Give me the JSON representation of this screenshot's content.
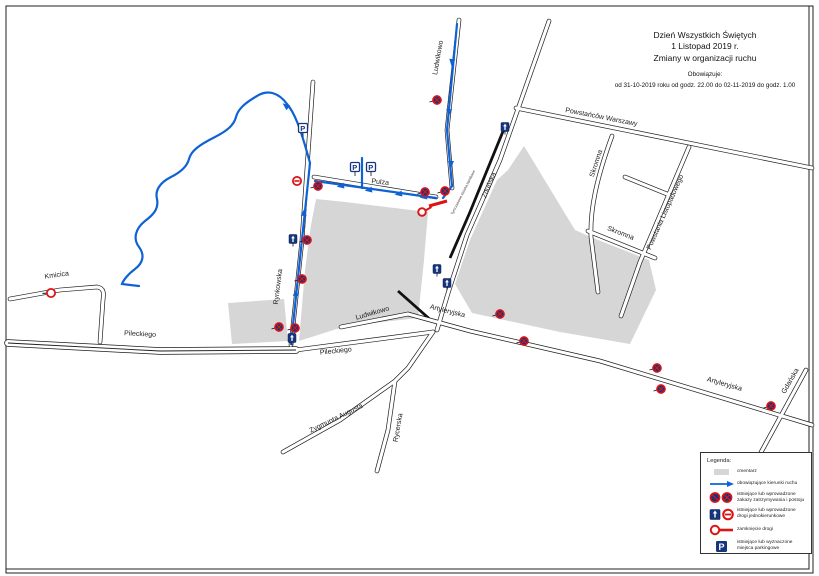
{
  "title_block": {
    "line1": "Dzień Wszystkich Świętych",
    "line2": "1 Listopad 2019 r.",
    "line3": "Zmiany w organizacji ruchu",
    "validity_label": "Obowiązuje:",
    "validity_text": "od 31-10-2019 roku od godz. 22.00 do 02-11-2019 do godz. 1.00"
  },
  "legend": {
    "title": "Legenda:",
    "items": [
      {
        "icon": "cemetery-swatch",
        "label": "cmentarz"
      },
      {
        "icon": "direction-arrow",
        "label": "obowiązujące kierunki ruchu"
      },
      {
        "icon": "no-stopping-signs",
        "label": "istniejące lub wprowadzone zakazy zatrzymywania i postoju"
      },
      {
        "icon": "one-way-signs",
        "label": "istniejące lub wprowadzone drogi jednokierunkowe"
      },
      {
        "icon": "road-closure",
        "label": "zamknięcie drogi"
      },
      {
        "icon": "parking-sign",
        "label": "istniejące lub wyznaczone miejsca parkingowe"
      }
    ]
  },
  "map": {
    "colors": {
      "road": "#1c1c1c",
      "route_blue": "#0e62d4",
      "sign_navy": "#16357f",
      "sign_red": "#dd1414",
      "cemetery": "#d6d6d6",
      "label": "#1a1a1a"
    },
    "streets": [
      {
        "name": "Pileckiego",
        "path": "M8 343 L160 351 L296 350",
        "dual": true,
        "labels": [
          {
            "text": "Pileckiego",
            "x": 140,
            "y": 336,
            "rot": 3
          }
        ]
      },
      {
        "name": "Pileckiego-wschod",
        "path": "M296 350 L433 332",
        "dual": false,
        "labels": [
          {
            "text": "Pileckiego",
            "x": 336,
            "y": 353,
            "rot": -6
          }
        ]
      },
      {
        "name": "Kmicica",
        "path": "M10 299 L60 290 L97 287 C104 288 104 293 103 300 L100 342",
        "dual": false,
        "labels": [
          {
            "text": "Kmicica",
            "x": 57,
            "y": 277,
            "rot": -8
          }
        ]
      },
      {
        "name": "Rynkowska",
        "path": "M313 82 L302 240 L291 345",
        "dual": false,
        "labels": [
          {
            "text": "Rynkowska",
            "x": 280,
            "y": 287,
            "rot": -83
          }
        ]
      },
      {
        "name": "Pulza",
        "path": "M314 177 L436 197",
        "dual": false,
        "labels": [
          {
            "text": "Pulza",
            "x": 380,
            "y": 184,
            "rot": 6
          }
        ]
      },
      {
        "name": "Ludwikowo-polnoc",
        "path": "M459 20 L447 130 L452 188",
        "dual": false,
        "labels": [
          {
            "text": "Ludwikowo",
            "x": 440,
            "y": 58,
            "rot": -80
          }
        ]
      },
      {
        "name": "Zdunska",
        "path": "M549 21 L500 160 L467 235 L449 290 L437 330",
        "dual": false,
        "labels": [
          {
            "text": "Zduńska",
            "x": 491,
            "y": 186,
            "rot": -67
          }
        ]
      },
      {
        "name": "Powstancow-Warszawy",
        "path": "M516 108 L812 168",
        "dual": false,
        "labels": [
          {
            "text": "Powstańców Warszawy",
            "x": 601,
            "y": 119,
            "rot": 11
          }
        ]
      },
      {
        "name": "Skromna-polnoc",
        "path": "M612 136 C596 180 590 210 591 237 L598 292",
        "dual": false,
        "labels": [
          {
            "text": "Skromna",
            "x": 598,
            "y": 164,
            "rot": -72
          }
        ]
      },
      {
        "name": "Skromna-poludnie",
        "path": "M588 231 L655 258",
        "dual": false,
        "labels": [
          {
            "text": "Skromna",
            "x": 620,
            "y": 235,
            "rot": 21
          }
        ]
      },
      {
        "name": "Powstania-Listopadowego",
        "path": "M689 147 L640 262 L621 316",
        "dual": false,
        "labels": [
          {
            "text": "Powstania Listopadowego",
            "x": 667,
            "y": 213,
            "rot": -66
          }
        ]
      },
      {
        "name": "lacznik-skromna",
        "path": "M625 177 L667 194",
        "dual": false,
        "labels": []
      },
      {
        "name": "Artyleryjska",
        "path": "M408 314 L470 331 L600 361 L812 425",
        "dual": false,
        "labels": [
          {
            "text": "Artyleryjska",
            "x": 447,
            "y": 313,
            "rot": 14
          },
          {
            "text": "Artyleryjska",
            "x": 724,
            "y": 386,
            "rot": 16
          }
        ]
      },
      {
        "name": "Zygmunta-Augusta",
        "path": "M433 332 L408 368 L395 381 L340 420 L283 452",
        "dual": false,
        "labels": [
          {
            "text": "Zygmunta Augusta",
            "x": 337,
            "y": 420,
            "rot": -26
          }
        ]
      },
      {
        "name": "Rycerska",
        "path": "M395 381 L388 430 L377 471",
        "dual": false,
        "labels": [
          {
            "text": "Rycerska",
            "x": 400,
            "y": 428,
            "rot": -80
          }
        ]
      },
      {
        "name": "Gdanska",
        "path": "M806 370 L765 445 L748 476",
        "dual": false,
        "labels": [
          {
            "text": "Gdańska",
            "x": 792,
            "y": 382,
            "rot": -60
          }
        ]
      },
      {
        "name": "Ludwikowo-poludnie",
        "path": "M341 327 L408 314",
        "dual": false,
        "labels": [
          {
            "text": "Ludwikowo",
            "x": 373,
            "y": 315,
            "rot": -16
          }
        ]
      }
    ],
    "railway": {
      "segments": [
        "M506 124 L470 212 L450 258",
        "M398 291 L433 322"
      ],
      "note": {
        "text": "Tymczasowe stoiska handlowe",
        "x": 464,
        "y": 193,
        "rot": -63
      }
    },
    "cemeteries": [
      "228,303 284,299 288,341 232,344",
      "316,199 345,202 428,212 424,260 418,318 346,326 299,341 305,270 311,225",
      "508,170 524,146 575,230 593,238 649,260 656,290 630,344 560,332 472,313 455,284 470,240 497,180"
    ],
    "routes": [
      "M310 163 C300 126 294 112 287 104 C279 93 268 89 257 96 C245 103 238 109 236 117 C234 125 227 131 215 137 C199 145 191 151 189 159 C187 167 179 173 171 177 C159 183 155 191 157 199 C159 209 153 215 145 221 C135 229 133 239 139 247 C145 255 143 263 135 269 C127 275 123 281 122 284 L139 286",
      "M291 344 L303 230 L310 163",
      "M315 181 L436 198",
      "M457 24 L447 130 L452 186 L443 198",
      "M362 158 L362 188"
    ],
    "route_arrows": [
      {
        "x": 286,
        "y": 106,
        "rot": -51
      },
      {
        "x": 304,
        "y": 213,
        "rot": 6
      },
      {
        "x": 296,
        "y": 293,
        "rot": 6
      },
      {
        "x": 341,
        "y": 186,
        "rot": -98
      },
      {
        "x": 369,
        "y": 190,
        "rot": -98
      },
      {
        "x": 399,
        "y": 194,
        "rot": -98
      },
      {
        "x": 424,
        "y": 197,
        "rot": -98
      },
      {
        "x": 452,
        "y": 62,
        "rot": 185
      },
      {
        "x": 449,
        "y": 112,
        "rot": 184
      },
      {
        "x": 451,
        "y": 164,
        "rot": 180
      }
    ],
    "signs": [
      {
        "type": "no-stopping",
        "x": 318,
        "y": 186
      },
      {
        "type": "no-stopping",
        "x": 307,
        "y": 240
      },
      {
        "type": "no-stopping",
        "x": 302,
        "y": 279
      },
      {
        "type": "no-stopping",
        "x": 279,
        "y": 327
      },
      {
        "type": "no-stopping",
        "x": 295,
        "y": 328
      },
      {
        "type": "no-stopping",
        "x": 437,
        "y": 100
      },
      {
        "type": "no-stopping",
        "x": 425,
        "y": 192
      },
      {
        "type": "no-stopping",
        "x": 445,
        "y": 191
      },
      {
        "type": "no-stopping",
        "x": 500,
        "y": 314
      },
      {
        "type": "no-stopping",
        "x": 524,
        "y": 341
      },
      {
        "type": "no-stopping",
        "x": 657,
        "y": 368
      },
      {
        "type": "no-stopping",
        "x": 661,
        "y": 389
      },
      {
        "type": "no-stopping",
        "x": 771,
        "y": 406
      },
      {
        "type": "no-entry",
        "x": 297,
        "y": 181
      },
      {
        "type": "no-traffic",
        "x": 51,
        "y": 293
      },
      {
        "type": "one-way",
        "x": 293,
        "y": 239
      },
      {
        "type": "one-way",
        "x": 292,
        "y": 338
      },
      {
        "type": "one-way",
        "x": 437,
        "y": 269
      },
      {
        "type": "one-way",
        "x": 447,
        "y": 283
      },
      {
        "type": "one-way",
        "x": 505,
        "y": 127
      },
      {
        "type": "parking",
        "x": 303,
        "y": 128
      },
      {
        "type": "parking",
        "x": 355,
        "y": 167
      },
      {
        "type": "parking",
        "x": 371,
        "y": 167
      },
      {
        "type": "closure",
        "x": 422,
        "y": 212
      }
    ],
    "closure_bar": {
      "x1": 429,
      "y1": 206,
      "x2": 447,
      "y2": 201
    }
  }
}
